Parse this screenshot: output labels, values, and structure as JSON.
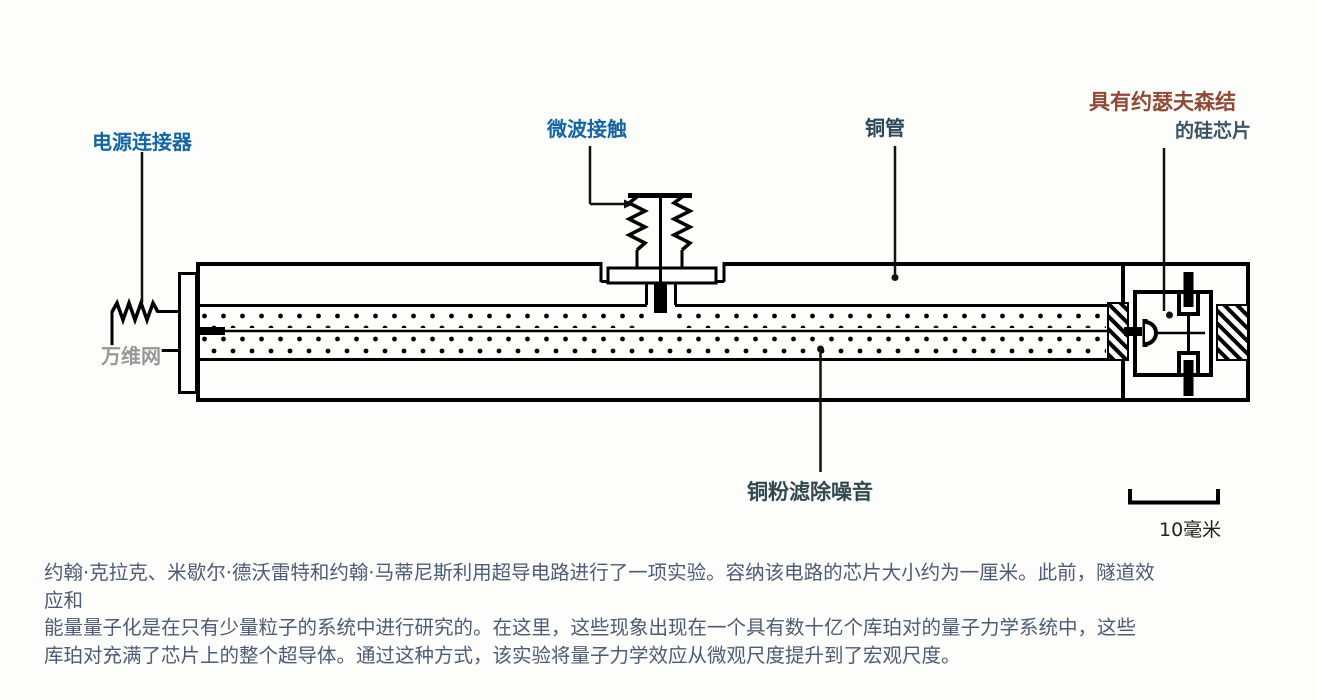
{
  "diagram": {
    "labels": {
      "power_connector": "电源连接器",
      "microwave_contact": "微波接触",
      "copper_tube": "铜管",
      "chip_line1": "具有约瑟夫森结",
      "chip_line2": "的硅芯片",
      "copper_powder": "铜粉滤除噪音",
      "scale": "10毫米",
      "watermark": "万维网"
    },
    "colors": {
      "label_blue": "#1465a3",
      "label_brown": "#8d4a36",
      "label_slate": "#2c4858",
      "powder_label": "#32494f",
      "caption_text": "#4d5b74",
      "ink": "#000000",
      "background": "#fdfdfc"
    }
  },
  "caption": {
    "lines": [
      "约翰·克拉克、米歇尔·德沃雷特和约翰·马蒂尼斯利用超导电路进行了一项实验。容纳该电路的芯片大小约为一厘米。此前，隧道效应和",
      "能量量子化是在只有少量粒子的系统中进行研究的。在这里，这些现象出现在一个具有数十亿个库珀对的量子力学系统中，这些",
      "库珀对充满了芯片上的整个超导体。通过这种方式，该实验将量子力学效应从微观尺度提升到了宏观尺度。"
    ]
  }
}
